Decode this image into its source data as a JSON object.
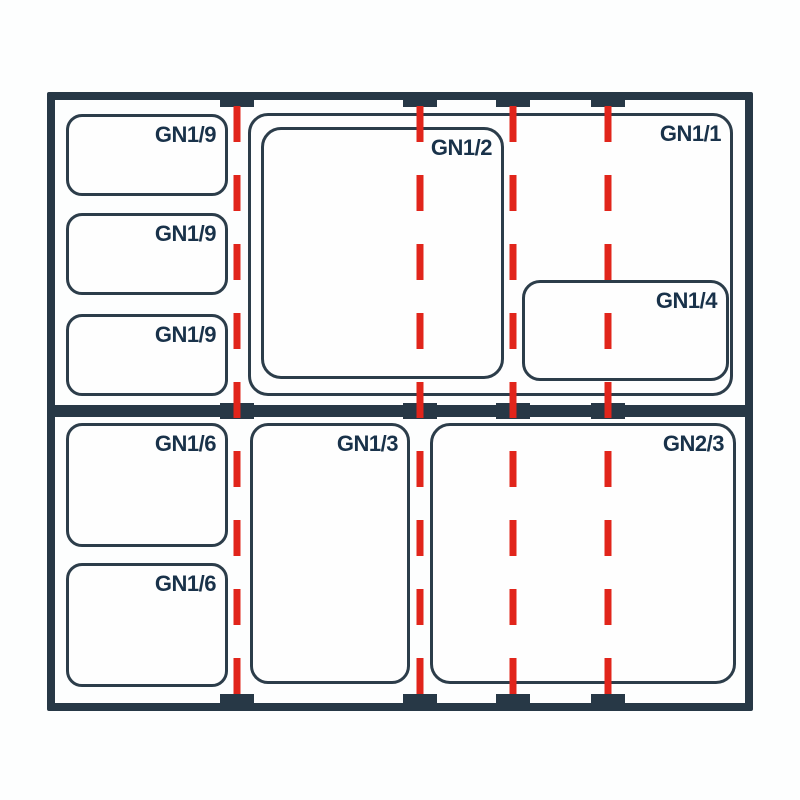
{
  "diagram": {
    "title": "gastronorm-pan-size-layout",
    "colors": {
      "frame": "#273846",
      "pan_outline": "#2c3d4a",
      "guide_red": "#e1251b",
      "label_text": "#19324a",
      "background": "#fdfefe"
    },
    "pans": [
      {
        "id": "gn19-a",
        "label": "GN1/9"
      },
      {
        "id": "gn19-b",
        "label": "GN1/9"
      },
      {
        "id": "gn19-c",
        "label": "GN1/9"
      },
      {
        "id": "gn11",
        "label": "GN1/1"
      },
      {
        "id": "gn12",
        "label": "GN1/2"
      },
      {
        "id": "gn14",
        "label": "GN1/4"
      },
      {
        "id": "gn16-a",
        "label": "GN1/6"
      },
      {
        "id": "gn16-b",
        "label": "GN1/6"
      },
      {
        "id": "gn13",
        "label": "GN1/3"
      },
      {
        "id": "gn23",
        "label": "GN2/3"
      }
    ],
    "guide_line_x": [
      237,
      420,
      513,
      608
    ],
    "tick_rows": 3,
    "ticks_per_row": 4
  }
}
